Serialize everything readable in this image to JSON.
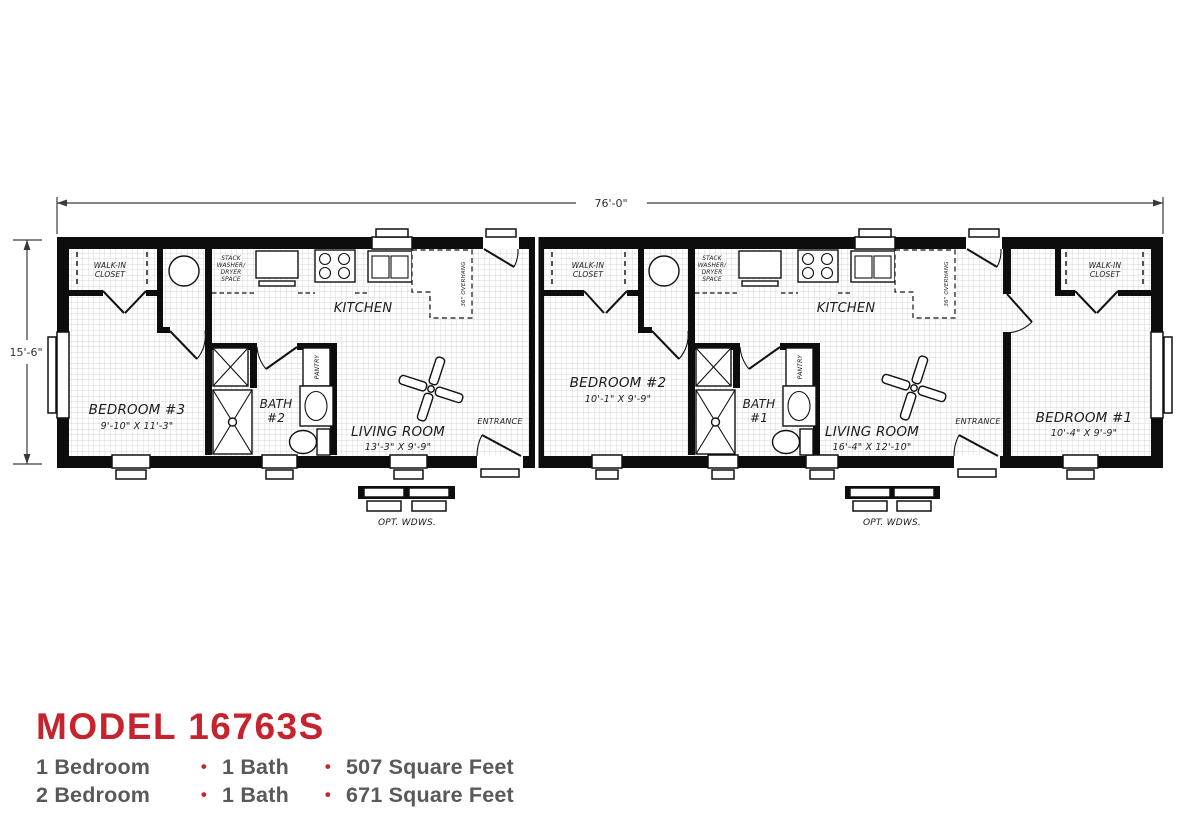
{
  "plan": {
    "width_label": "76'-0\"",
    "height_label": "15'-6\"",
    "shared": {
      "kitchen": "KITCHEN",
      "walk_in": [
        "WALK-IN",
        "CLOSET"
      ],
      "stack": [
        "STACK",
        "WASHER/",
        "DRYER",
        "SPACE"
      ],
      "pantry": "PANTRY",
      "overhang": "36\" OVERHANG",
      "entrance": "ENTRANCE",
      "opt_windows": "OPT. WDWS."
    },
    "rooms": {
      "bedroom3": {
        "name": "BEDROOM #3",
        "dims": "9'-10\" X 11'-3\""
      },
      "bedroom2": {
        "name": "BEDROOM #2",
        "dims": "10'-1\" X 9'-9\""
      },
      "bedroom1": {
        "name": "BEDROOM #1",
        "dims": "10'-4\" X 9'-9\""
      },
      "bath2": {
        "name": "BATH",
        "num": "#2"
      },
      "bath1": {
        "name": "BATH",
        "num": "#1"
      },
      "living_left": {
        "name": "LIVING ROOM",
        "dims": "13'-3\" X 9'-9\""
      },
      "living_right": {
        "name": "LIVING ROOM",
        "dims": "16'-4\" X 12'-10\""
      }
    }
  },
  "title_block": {
    "model": "MODEL 16763S",
    "bullet": "•",
    "lines": [
      {
        "bedrooms": "1 Bedroom",
        "baths": "1 Bath",
        "sqft": "507 Square Feet"
      },
      {
        "bedrooms": "2 Bedroom",
        "baths": "1 Bath",
        "sqft": "671 Square Feet"
      }
    ]
  },
  "colors": {
    "accent_red": "#c5242e",
    "text_gray": "#58595b"
  }
}
